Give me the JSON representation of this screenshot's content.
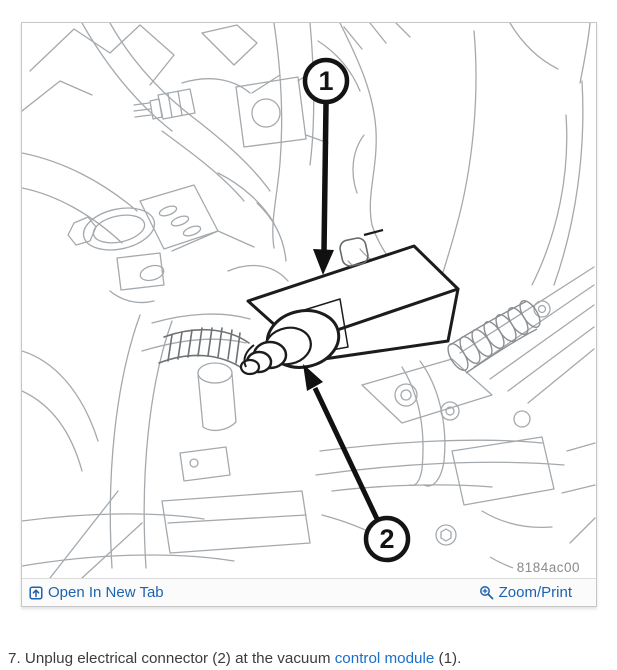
{
  "figure": {
    "code": "8184ac00",
    "callout_1": "1",
    "callout_2": "2"
  },
  "toolbar": {
    "open_in_new_tab_label": "Open In New Tab",
    "zoom_print_label": "Zoom/Print"
  },
  "step": {
    "text_before_link": "7. Unplug electrical connector (2) at the vacuum ",
    "link_text": "control module",
    "text_after_link": " (1)."
  },
  "colors": {
    "toolbar_link_blue": "#1e63ae",
    "step_link_blue": "#1a6fca",
    "figure_code_gray": "#8b8b8b",
    "frame_border_gray": "#c6c6c6",
    "diagram_line_gray": "#a4a9ad",
    "diagram_bold_black": "#1c1c1c"
  }
}
